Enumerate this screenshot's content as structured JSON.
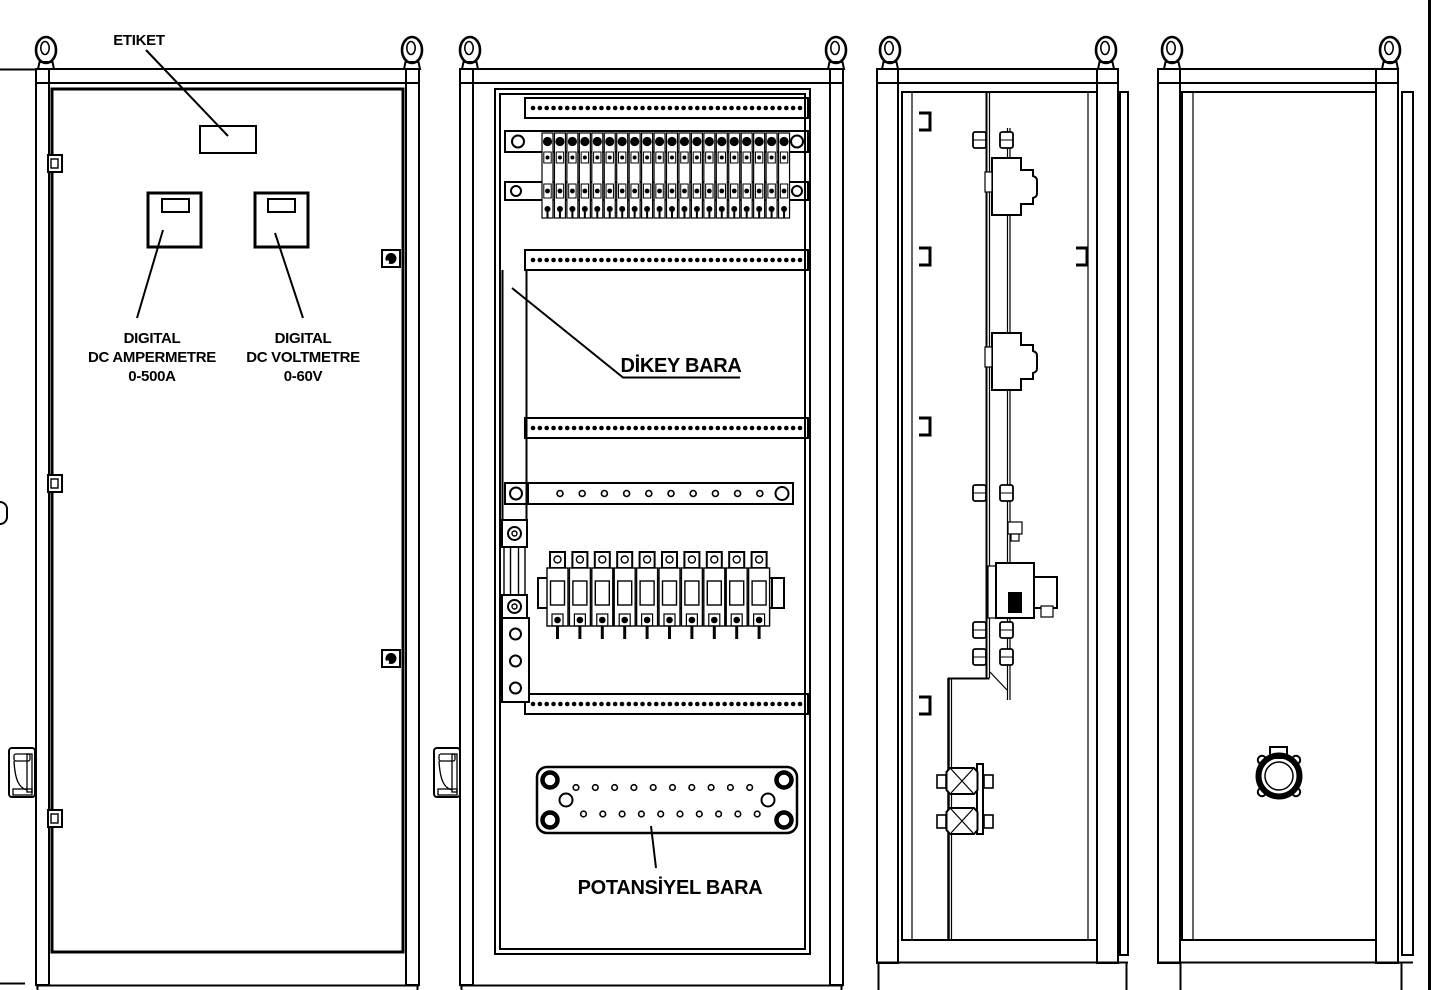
{
  "drawing": {
    "title_labels": {
      "etiket": "ETIKET",
      "ampermetre_l1": "DIGITAL",
      "ampermetre_l2": "DC AMPERMETRE",
      "ampermetre_l3": "0-500A",
      "voltmetre_l1": "DIGITAL",
      "voltmetre_l2": "DC VOLTMETRE",
      "voltmetre_l3": "0-60V",
      "dikey_bara": "DİKEY BARA",
      "potansiyel_bara": "POTANSİYEL BARA"
    },
    "counts": {
      "panels": 4,
      "lifting_eyebolts": 8,
      "door_hinges": 3,
      "door_locks": 2,
      "cable_duct_strips": 4,
      "strip_holes": 40,
      "terminal_blocks": 20,
      "fuse_units": 10,
      "busbar_holes": 10,
      "potential_bar_top_holes": 10,
      "potential_bar_bottom_holes": 10
    },
    "colors": {
      "line": "#000000",
      "background": "#ffffff"
    }
  }
}
